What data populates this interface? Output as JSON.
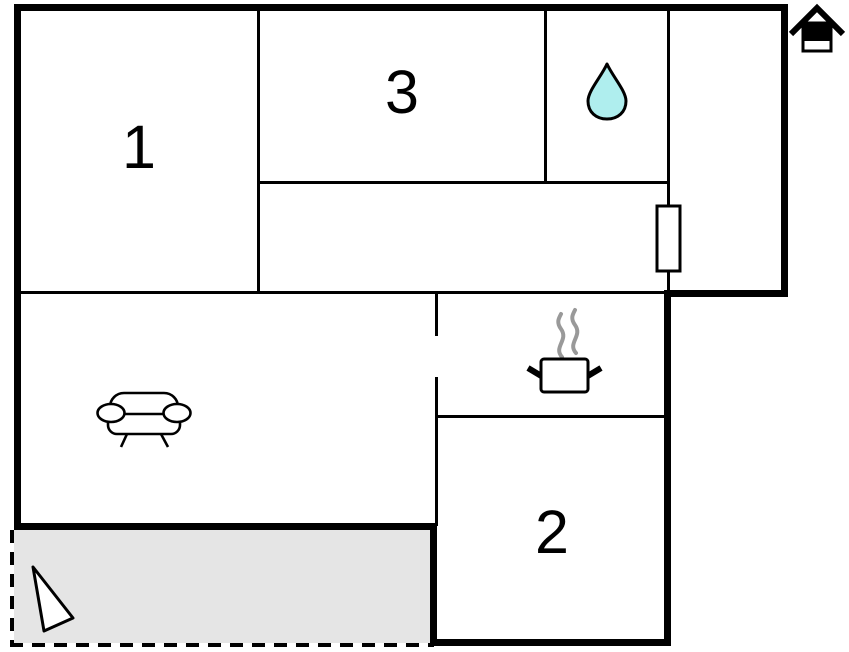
{
  "floorplan": {
    "type": "apartment-floor-plan",
    "rooms": [
      {
        "id": "room-1",
        "label": "1"
      },
      {
        "id": "room-2",
        "label": "2"
      },
      {
        "id": "room-3",
        "label": "3"
      }
    ],
    "symbols": [
      {
        "name": "house-icon",
        "meaning": "property / entrance marker"
      },
      {
        "name": "water-drop-icon",
        "meaning": "bathroom"
      },
      {
        "name": "cooking-pot-icon",
        "meaning": "kitchen"
      },
      {
        "name": "sofa-icon",
        "meaning": "living room"
      },
      {
        "name": "direction-arrow-icon",
        "meaning": "orientation arrow on terrace"
      },
      {
        "name": "radiator-symbol",
        "meaning": "wall fixture"
      }
    ],
    "colors": {
      "wall": "#000000",
      "background": "#ffffff",
      "water_drop_fill": "#afeeee",
      "terrace_fill": "#e5e5e5",
      "steam": "#999999"
    }
  }
}
